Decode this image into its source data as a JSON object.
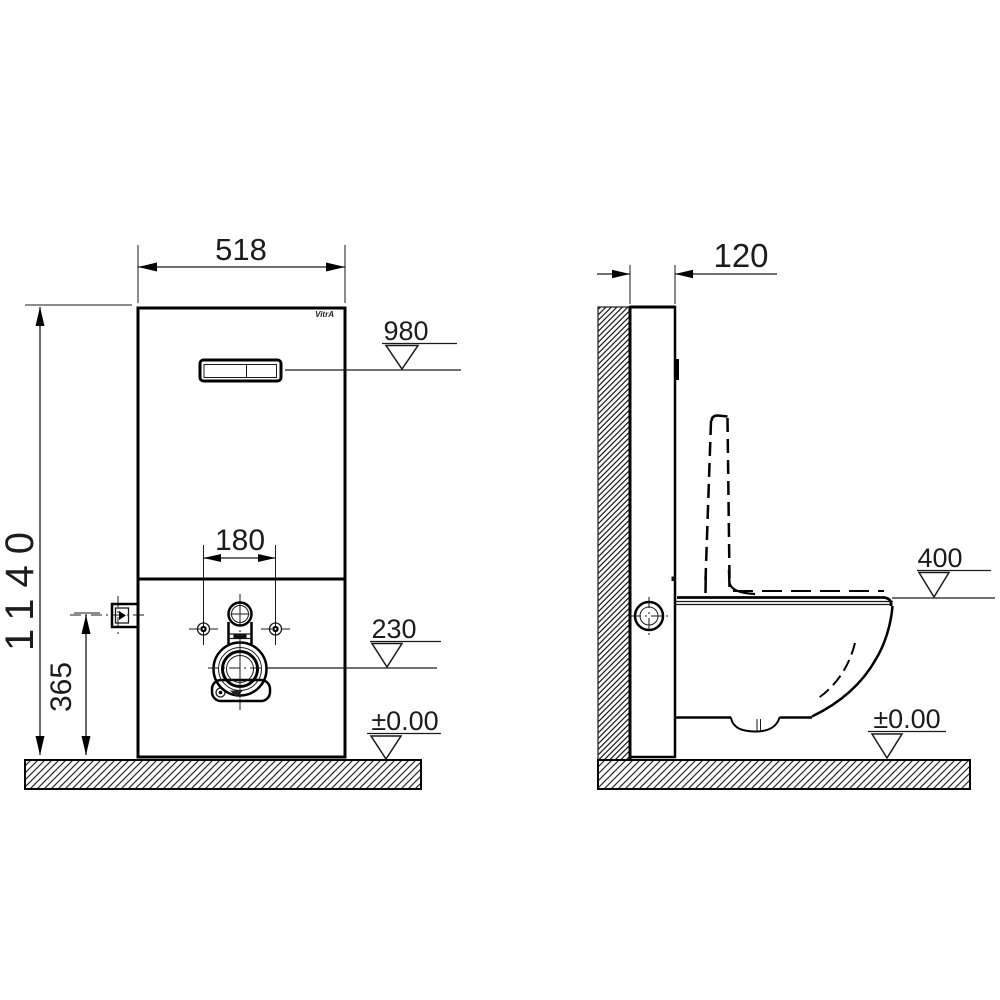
{
  "brand_logo": "VitrA",
  "front_view": {
    "width_dim": "518",
    "height_dim": "1140",
    "flush_plate_level": "980",
    "fixing_bolt_spacing": "180",
    "water_inlet_height": "365",
    "outlet_level": "230",
    "floor_level": "±0.00"
  },
  "side_view": {
    "depth_dim": "120",
    "rim_height_level": "400",
    "floor_level": "±0.00"
  }
}
